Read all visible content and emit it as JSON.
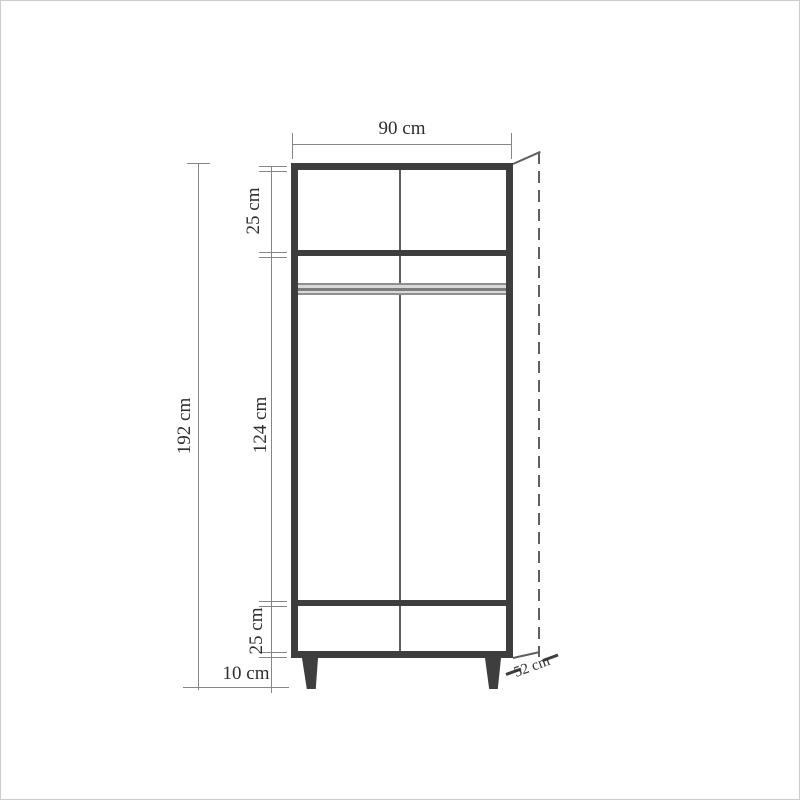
{
  "diagram": {
    "type": "furniture-dimension-drawing",
    "subject": "two-door wardrobe front elevation with depth perspective",
    "colors": {
      "background": "#ffffff",
      "frame_border": "#cccccc",
      "carcass_outline": "#3e3e3e",
      "dimension_lines": "#868686",
      "rail_band": "#8f8f8f",
      "text": "#2e2e2e"
    },
    "dimensions": {
      "width": {
        "label": "90 cm",
        "value_cm": 90
      },
      "overall_height": {
        "label": "192 cm",
        "value_cm": 192
      },
      "top_section_height": {
        "label": "25 cm",
        "value_cm": 25
      },
      "door_section_height": {
        "label": "124 cm",
        "value_cm": 124
      },
      "bottom_section_height": {
        "label": "25 cm",
        "value_cm": 25
      },
      "leg_height": {
        "label": "10 cm",
        "value_cm": 10
      },
      "depth": {
        "label": "52 cm",
        "value_cm": 52
      }
    }
  }
}
